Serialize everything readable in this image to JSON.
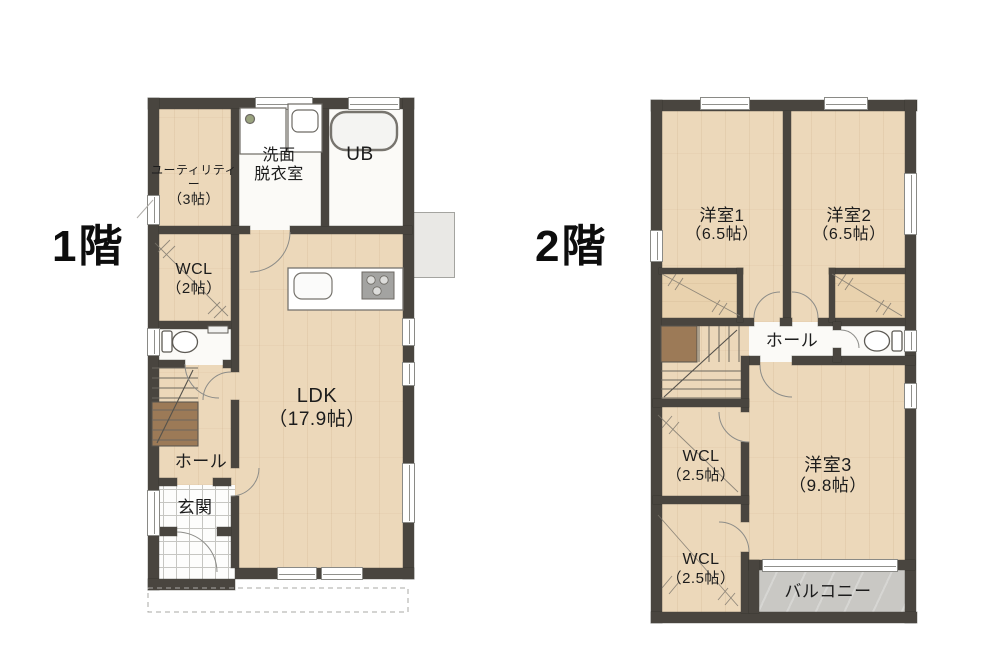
{
  "floors": {
    "floor1": {
      "label": "1階",
      "rooms": {
        "utility": {
          "name": "ユーティリティー",
          "size": "（3帖）"
        },
        "senmen": {
          "name_line1": "洗面",
          "name_line2": "脱衣室"
        },
        "ub": {
          "name": "UB"
        },
        "wcl": {
          "name": "WCL",
          "size": "（2帖）"
        },
        "ldk": {
          "name": "LDK",
          "size": "（17.9帖）"
        },
        "hall": {
          "name": "ホール"
        },
        "genkan": {
          "name": "玄関"
        }
      }
    },
    "floor2": {
      "label": "2階",
      "rooms": {
        "yoshitsu1": {
          "name": "洋室1",
          "size": "（6.5帖）"
        },
        "yoshitsu2": {
          "name": "洋室2",
          "size": "（6.5帖）"
        },
        "hall": {
          "name": "ホール"
        },
        "wcl_upper": {
          "name": "WCL",
          "size": "（2.5帖）"
        },
        "wcl_lower": {
          "name": "WCL",
          "size": "（2.5帖）"
        },
        "yoshitsu3": {
          "name": "洋室3",
          "size": "（9.8帖）"
        },
        "balcony": {
          "name": "バルコニー"
        }
      }
    }
  },
  "icons": [
    "bathtub-icon",
    "washer-icon",
    "vanity-sink-icon",
    "kitchen-sink-icon",
    "stove-icon",
    "toilet-icon",
    "stairs-icon",
    "door-swing-icon",
    "window-icon"
  ],
  "colors": {
    "wall": "#49453f",
    "room_tan": "#ecd8ba",
    "room_white": "#fbfaf7",
    "closet_tan": "#e9d2ae",
    "stair_wood": "#9c7a57",
    "balcony_gray": "#c9c8c4",
    "exterior_gray": "#e9e8e5",
    "text": "#1c1c1c"
  }
}
